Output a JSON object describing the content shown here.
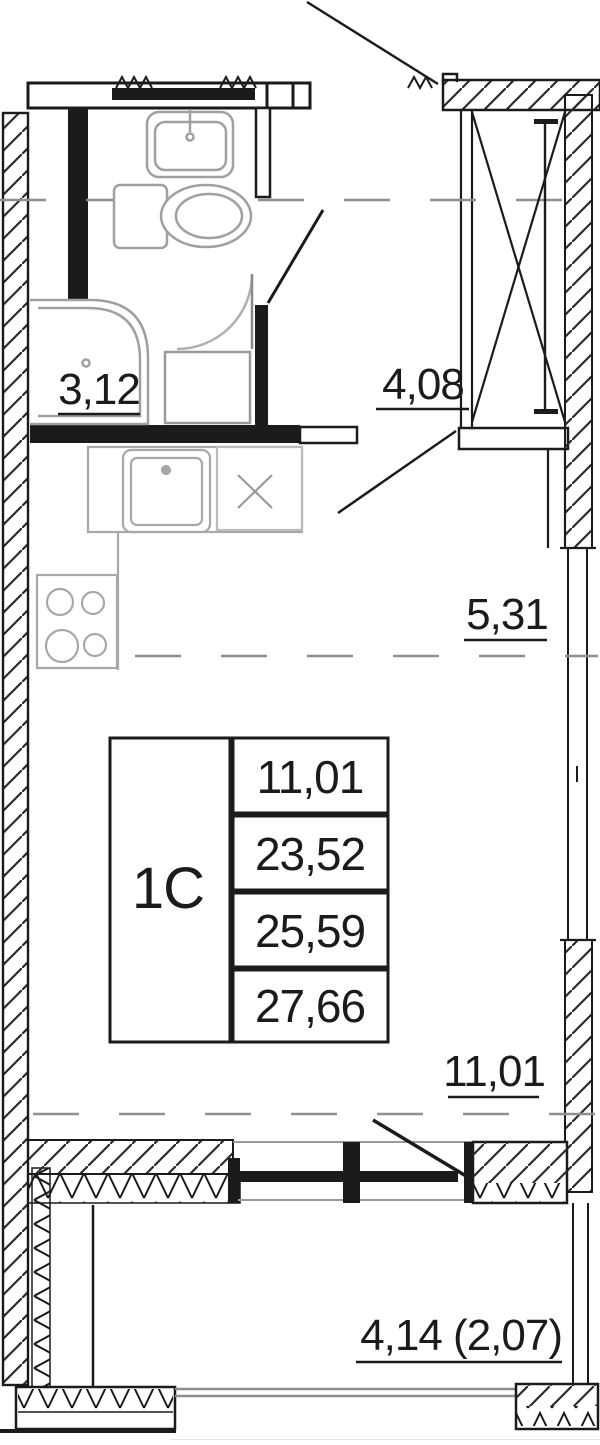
{
  "plan": {
    "rooms": {
      "bathroom": {
        "area": "3,12"
      },
      "hall": {
        "area": "4,08"
      },
      "kitchen": {
        "area": "5,31"
      },
      "living_room": {
        "area": "11,01"
      },
      "balcony": {
        "area": "4,14 (2,07)"
      }
    },
    "info_table": {
      "unit_type": "1C",
      "values": [
        "11,01",
        "23,52",
        "25,59",
        "27,66"
      ]
    },
    "colors": {
      "line": "#1b1b1b",
      "fixture": "#a0a0a0",
      "dash": "#8f8f8f"
    }
  }
}
